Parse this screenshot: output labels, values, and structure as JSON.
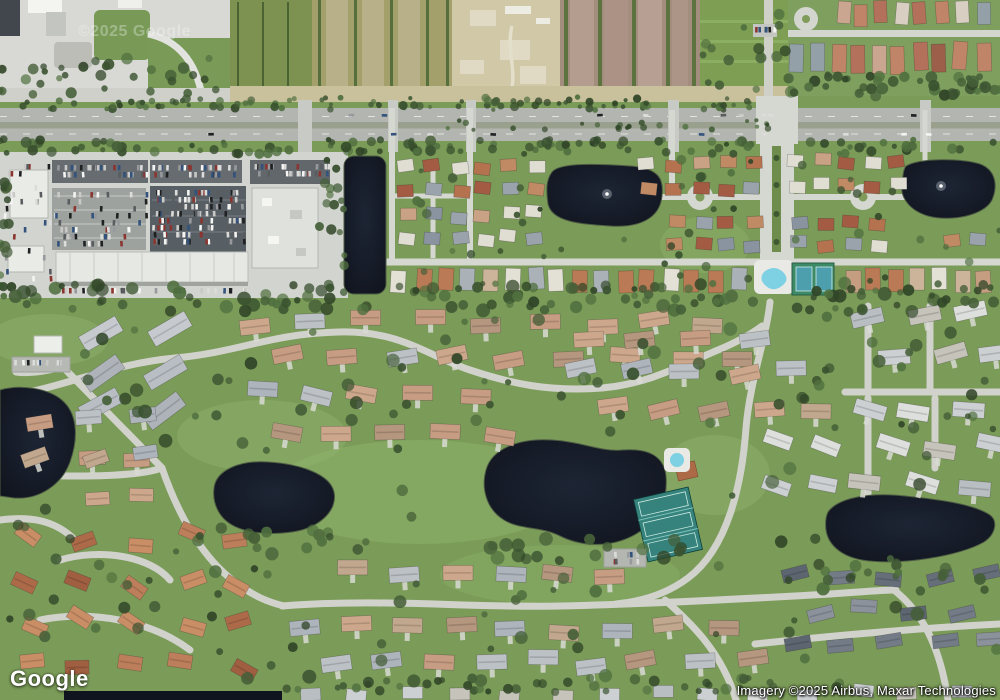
{
  "branding": {
    "logo": "Google"
  },
  "watermark": {
    "text": "©2025 Google"
  },
  "attribution": {
    "text": "Imagery ©2025 Airbus, Maxar Technologies"
  },
  "colors": {
    "grass": "#7b9b58",
    "grass_light": "#8db26b",
    "water": "#151a26",
    "shore": "#4e5c44",
    "road_residential": "#d5d7d1",
    "road_community": "#d0d2cb",
    "highway": "#b2b5b0",
    "highway_median": "#99a08e",
    "parking_light": "#d2d4cf",
    "parking_dark": "#5a6165",
    "building_white": "#e9ebe7",
    "tennis_green": "#3c8a67",
    "tennis_court_blue": "#4d9fae",
    "tennis_lower": "#35837c",
    "pool_blue": "#7ed0e3",
    "field_tan": "#cfc7a6",
    "field_mauve": "#a38d7d",
    "hedge": "#3a5230",
    "pavement": "#d8d9d4"
  },
  "map": {
    "seed": 20250607,
    "palettes": {
      "trees": [
        "#3a5230",
        "#455f38",
        "#314628",
        "#50703f"
      ],
      "cars": [
        "#f4f4f2",
        "#dcdcda",
        "#1f2022",
        "#97999c",
        "#8a3530",
        "#33527c",
        "#c9c9c7",
        "#5a5d60"
      ],
      "lowerMain": [
        "#c69c82",
        "#bcc1c6",
        "#c1a78d",
        "#aeb4bb",
        "#cda78b",
        "#b5967e"
      ],
      "grayBig": [
        "#b9bec4",
        "#c6cacf",
        "#aeb3b9"
      ],
      "terracotta": [
        "#ad6a49",
        "#bd7f5b",
        "#a05f41",
        "#c98e66"
      ],
      "slate": [
        "#5d6570",
        "#737b86",
        "#8b929b",
        "#666e79"
      ],
      "whitegray": [
        "#ccd0d2",
        "#dddfdc",
        "#b9bec3",
        "#c6c3ba"
      ],
      "upperN": [
        "#b4724f",
        "#c08a64",
        "#a35c43",
        "#c9a184",
        "#9aa3ab",
        "#e0ddd2",
        "#8a93a0"
      ],
      "southRow": [
        "#c59e82",
        "#e3e0d6",
        "#b97a55",
        "#aab2b8",
        "#cbb49a"
      ],
      "topRight": [
        "#b3705a",
        "#c08568",
        "#9c5f49",
        "#caa58f",
        "#93a0a8",
        "#d8cfc2"
      ]
    },
    "houseClusters": [
      {
        "id": "gray-diag",
        "x0": 100,
        "y0": 332,
        "cols": 2,
        "rows": 3,
        "dx": 68,
        "dy": 38,
        "w": 42,
        "h": 17,
        "angle": -33,
        "jA": 6,
        "jXY": 4,
        "colors": "grayBig",
        "stagger": false,
        "drive": false
      },
      {
        "id": "north-band",
        "x0": 256,
        "y0": 322,
        "cols": 9,
        "rows": 2,
        "dx": 57,
        "dy": 36,
        "w": 30,
        "h": 15,
        "angle": -4,
        "jA": 8,
        "jXY": 5,
        "colors": "lowerMain",
        "stagger": true,
        "drive": true
      },
      {
        "id": "left-south",
        "x0": 38,
        "y0": 420,
        "cols": 3,
        "rows": 2,
        "dx": 50,
        "dy": 42,
        "w": 26,
        "h": 14,
        "angle": -12,
        "jA": 10,
        "jXY": 5,
        "colors": "lowerMain",
        "stagger": false,
        "drive": true
      },
      {
        "id": "mid-band",
        "x0": 258,
        "y0": 392,
        "cols": 5,
        "rows": 2,
        "dx": 54,
        "dy": 40,
        "w": 30,
        "h": 15,
        "angle": 6,
        "jA": 8,
        "jXY": 5,
        "colors": "lowerMain",
        "stagger": true,
        "drive": true
      },
      {
        "id": "mid-east-n",
        "x0": 588,
        "y0": 338,
        "cols": 4,
        "rows": 1,
        "dx": 54,
        "dy": 0,
        "w": 30,
        "h": 15,
        "angle": -8,
        "jA": 8,
        "jXY": 5,
        "colors": "lowerMain",
        "stagger": false,
        "drive": true
      },
      {
        "id": "mid-east-s",
        "x0": 584,
        "y0": 372,
        "cols": 5,
        "rows": 2,
        "dx": 52,
        "dy": 38,
        "w": 30,
        "h": 15,
        "angle": -6,
        "jA": 8,
        "jXY": 5,
        "colors": "lowerMain",
        "stagger": true,
        "drive": true
      },
      {
        "id": "pond-south",
        "x0": 352,
        "y0": 572,
        "cols": 6,
        "rows": 1,
        "dx": 52,
        "dy": 0,
        "w": 30,
        "h": 15,
        "angle": 4,
        "jA": 8,
        "jXY": 5,
        "colors": "lowerMain",
        "stagger": false,
        "drive": true
      },
      {
        "id": "south-band",
        "x0": 306,
        "y0": 628,
        "cols": 9,
        "rows": 2,
        "dx": 52,
        "dy": 34,
        "w": 30,
        "h": 15,
        "angle": -3,
        "jA": 8,
        "jXY": 5,
        "colors": "lowerMain",
        "stagger": true,
        "drive": true
      },
      {
        "id": "sw-terracotta",
        "x0": 30,
        "y0": 538,
        "cols": 5,
        "rows": 4,
        "dx": 52,
        "dy": 42,
        "w": 24,
        "h": 14,
        "angle": 10,
        "jA": 30,
        "jXY": 8,
        "colors": "terracotta",
        "stagger": false,
        "drive": false
      },
      {
        "id": "w-mid",
        "x0": 98,
        "y0": 455,
        "cols": 2,
        "rows": 2,
        "dx": 46,
        "dy": 40,
        "w": 24,
        "h": 13,
        "angle": -8,
        "jA": 14,
        "jXY": 5,
        "colors": "lowerMain",
        "stagger": false,
        "drive": false
      },
      {
        "id": "e-band-n",
        "x0": 868,
        "y0": 316,
        "cols": 3,
        "rows": 2,
        "dx": 52,
        "dy": 38,
        "w": 32,
        "h": 15,
        "angle": -10,
        "jA": 10,
        "jXY": 5,
        "colors": "whitegray",
        "stagger": true,
        "drive": true
      },
      {
        "id": "e-band-s",
        "x0": 866,
        "y0": 412,
        "cols": 3,
        "rows": 3,
        "dx": 52,
        "dy": 36,
        "w": 32,
        "h": 15,
        "angle": 8,
        "jA": 10,
        "jXY": 5,
        "colors": "whitegray",
        "stagger": true,
        "drive": true
      },
      {
        "id": "se-slate",
        "x0": 794,
        "y0": 576,
        "cols": 5,
        "rows": 3,
        "dx": 49,
        "dy": 34,
        "w": 26,
        "h": 13,
        "angle": -6,
        "jA": 12,
        "jXY": 5,
        "colors": "slate",
        "stagger": true,
        "drive": false
      },
      {
        "id": "bottom-row",
        "x0": 310,
        "y0": 694,
        "cols": 14,
        "rows": 1,
        "dx": 50,
        "dy": 0,
        "w": 20,
        "h": 12,
        "angle": 2,
        "jA": 6,
        "jXY": 4,
        "colors": "whitegray",
        "stagger": false,
        "drive": false
      },
      {
        "id": "c-road-east",
        "x0": 775,
        "y0": 444,
        "cols": 2,
        "rows": 2,
        "dx": 50,
        "dy": 40,
        "w": 28,
        "h": 14,
        "angle": 18,
        "jA": 8,
        "jXY": 5,
        "colors": "whitegray",
        "stagger": false,
        "drive": false
      },
      {
        "id": "u-grid-1",
        "x0": 406,
        "y0": 168,
        "cols": 3,
        "rows": 4,
        "dx": 27,
        "dy": 24,
        "w": 16,
        "h": 12,
        "angle": 0,
        "jA": 8,
        "jXY": 3,
        "colors": "upperN",
        "stagger": false,
        "drive": false
      },
      {
        "id": "u-grid-2",
        "x0": 484,
        "y0": 166,
        "cols": 3,
        "rows": 4,
        "dx": 26,
        "dy": 24,
        "w": 16,
        "h": 12,
        "angle": 0,
        "jA": 8,
        "jXY": 3,
        "colors": "upperN",
        "stagger": false,
        "drive": false
      },
      {
        "id": "u-cds-w-n",
        "x0": 648,
        "y0": 164,
        "cols": 5,
        "rows": 2,
        "dx": 26,
        "dy": 24,
        "w": 16,
        "h": 12,
        "angle": 0,
        "jA": 8,
        "jXY": 3,
        "colors": "upperN",
        "stagger": false,
        "drive": false
      },
      {
        "id": "u-cds-w-s",
        "x0": 676,
        "y0": 222,
        "cols": 4,
        "rows": 2,
        "dx": 26,
        "dy": 22,
        "w": 16,
        "h": 12,
        "angle": 0,
        "jA": 8,
        "jXY": 3,
        "colors": "upperN",
        "stagger": false,
        "drive": false
      },
      {
        "id": "u-cds-e-n",
        "x0": 798,
        "y0": 162,
        "cols": 5,
        "rows": 2,
        "dx": 25,
        "dy": 24,
        "w": 16,
        "h": 12,
        "angle": 0,
        "jA": 8,
        "jXY": 3,
        "colors": "upperN",
        "stagger": false,
        "drive": false
      },
      {
        "id": "u-cds-e-s",
        "x0": 800,
        "y0": 222,
        "cols": 4,
        "rows": 2,
        "dx": 26,
        "dy": 22,
        "w": 16,
        "h": 12,
        "angle": 0,
        "jA": 8,
        "jXY": 3,
        "colors": "upperN",
        "stagger": false,
        "drive": false
      },
      {
        "id": "u-far-e",
        "x0": 950,
        "y0": 240,
        "cols": 2,
        "rows": 1,
        "dx": 26,
        "dy": 0,
        "w": 16,
        "h": 12,
        "angle": 0,
        "jA": 8,
        "jXY": 3,
        "colors": "upperN",
        "stagger": false,
        "drive": false
      },
      {
        "id": "south-row-w",
        "x0": 400,
        "y0": 280,
        "cols": 16,
        "rows": 1,
        "dx": 22.5,
        "dy": 0,
        "w": 15,
        "h": 22,
        "angle": 0,
        "jA": 4,
        "jXY": 2,
        "colors": "southRow",
        "stagger": false,
        "drive": false
      },
      {
        "id": "south-row-e",
        "x0": 852,
        "y0": 280,
        "cols": 7,
        "rows": 1,
        "dx": 22,
        "dy": 0,
        "w": 15,
        "h": 22,
        "angle": 0,
        "jA": 4,
        "jXY": 2,
        "colors": "southRow",
        "stagger": false,
        "drive": false
      },
      {
        "id": "top-right-1",
        "x0": 842,
        "y0": 14,
        "cols": 8,
        "rows": 1,
        "dx": 20,
        "dy": 0,
        "w": 13,
        "h": 22,
        "angle": 0,
        "jA": 5,
        "jXY": 3,
        "colors": "topRight",
        "stagger": false,
        "drive": false
      },
      {
        "id": "top-right-2",
        "x0": 797,
        "y0": 58,
        "cols": 10,
        "rows": 1,
        "dx": 20.5,
        "dy": 0,
        "w": 14,
        "h": 28,
        "angle": 0,
        "jA": 5,
        "jXY": 3,
        "colors": "topRight",
        "stagger": false,
        "drive": false
      }
    ],
    "treePatches": [
      {
        "box": [
          0,
          97,
          788,
          110
        ],
        "n": 100,
        "r": [
          2,
          4.5
        ],
        "gaps": [
          [
            296,
            314
          ],
          [
            384,
            400
          ],
          [
            462,
            478
          ],
          [
            664,
            682
          ],
          [
            752,
            800
          ],
          [
            916,
            936
          ]
        ]
      },
      {
        "box": [
          0,
          139,
          1000,
          154
        ],
        "n": 115,
        "r": [
          2.5,
          5.5
        ],
        "gaps": [
          [
            296,
            314
          ],
          [
            384,
            400
          ],
          [
            462,
            478
          ],
          [
            664,
            682
          ],
          [
            752,
            800
          ],
          [
            916,
            936
          ]
        ]
      },
      {
        "box": [
          438,
          120,
          768,
          130
        ],
        "n": 24,
        "r": [
          2,
          3.5
        ]
      },
      {
        "box": [
          788,
          74,
          1000,
          96
        ],
        "n": 42,
        "r": [
          3,
          6
        ]
      },
      {
        "box": [
          0,
          283,
          1000,
          312
        ],
        "n": 130,
        "r": [
          3,
          7
        ],
        "gaps": [
          [
            758,
            796
          ]
        ]
      },
      {
        "box": [
          0,
          315,
          1000,
          688
        ],
        "n": 150,
        "r": [
          3,
          7
        ],
        "avoid": [
          [
            0,
            78,
            384,
            500
          ],
          [
            204,
            340,
            456,
            538
          ],
          [
            476,
            672,
            432,
            552
          ],
          [
            822,
            1000,
            490,
            568
          ],
          [
            596,
            718,
            442,
            582
          ],
          [
            6,
            78,
            328,
            382
          ]
        ]
      },
      {
        "box": [
          348,
          152,
          1000,
          296
        ],
        "n": 55,
        "r": [
          2.5,
          5
        ],
        "avoid": [
          [
            342,
            388,
            154,
            296
          ],
          [
            544,
            668,
            160,
            234
          ],
          [
            898,
            1000,
            154,
            226
          ],
          [
            752,
            846,
            256,
            298
          ]
        ]
      },
      {
        "box": [
          0,
          150,
          10,
          298
        ],
        "n": 12,
        "r": [
          3,
          6
        ]
      },
      {
        "box": [
          318,
          158,
          348,
          296
        ],
        "n": 16,
        "r": [
          3,
          6
        ]
      },
      {
        "box": [
          470,
          538,
          690,
          562
        ],
        "n": 18,
        "r": [
          4,
          7
        ]
      },
      {
        "box": [
          196,
          528,
          344,
          552
        ],
        "n": 12,
        "r": [
          3.5,
          6
        ]
      },
      {
        "box": [
          818,
          558,
          956,
          578
        ],
        "n": 12,
        "r": [
          3.5,
          6
        ]
      },
      {
        "box": [
          95,
          58,
          230,
          96
        ],
        "n": 18,
        "r": [
          3,
          6
        ]
      },
      {
        "box": [
          0,
          66,
          95,
          96
        ],
        "n": 14,
        "r": [
          3,
          6
        ]
      },
      {
        "box": [
          700,
          4,
          786,
          92
        ],
        "n": 14,
        "r": [
          3,
          6
        ]
      },
      {
        "box": [
          284,
          678,
          776,
          692
        ],
        "n": 40,
        "r": [
          3,
          5.5
        ]
      }
    ],
    "carLots": [
      {
        "box": [
          54,
          163,
          92,
          18
        ],
        "n": 36
      },
      {
        "box": [
          152,
          163,
          88,
          18
        ],
        "n": 36
      },
      {
        "box": [
          152,
          188,
          94,
          62
        ],
        "n": 120
      },
      {
        "box": [
          54,
          190,
          92,
          58
        ],
        "n": 55
      },
      {
        "box": [
          252,
          162,
          76,
          20
        ],
        "n": 32
      },
      {
        "box": [
          58,
          286,
          186,
          10
        ],
        "n": 26
      },
      {
        "box": [
          2,
          162,
          50,
          130
        ],
        "n": 30
      },
      {
        "box": [
          753,
          25,
          22,
          12
        ],
        "n": 8
      },
      {
        "box": [
          14,
          358,
          54,
          13
        ],
        "n": 10
      },
      {
        "box": [
          606,
          550,
          40,
          16
        ],
        "n": 8
      },
      {
        "box": [
          80,
          112,
          840,
          8
        ],
        "n": 9,
        "horiz": true
      },
      {
        "box": [
          120,
          131,
          820,
          8
        ],
        "n": 9,
        "horiz": true
      }
    ]
  }
}
